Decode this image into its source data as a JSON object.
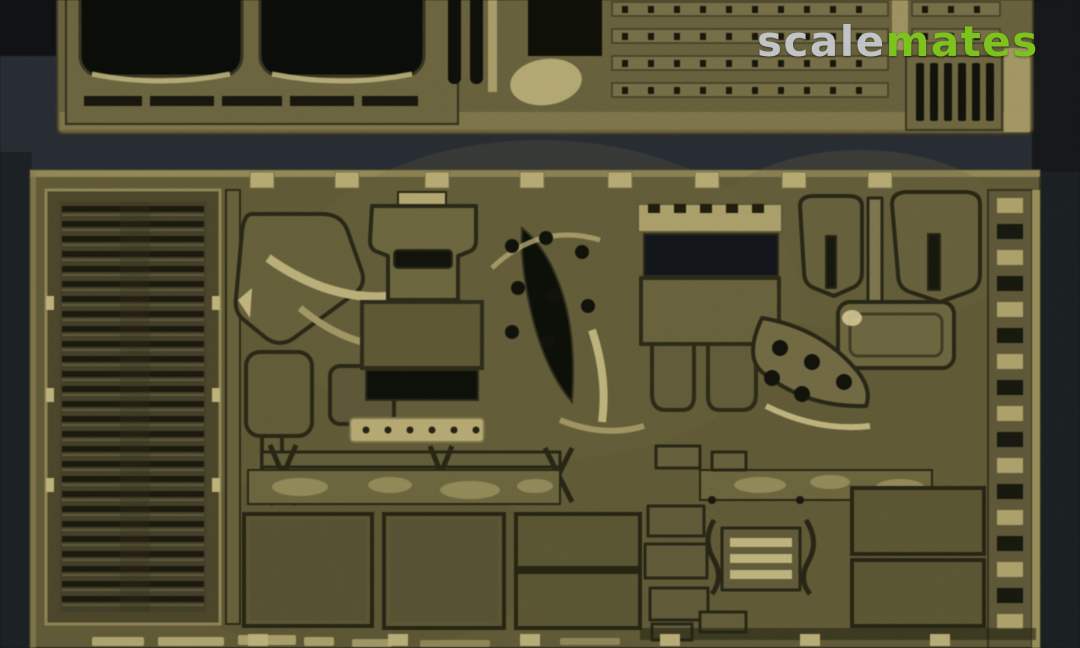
{
  "image_type": "photograph",
  "subject": "Two olive-brass photo-etched detail frets for a scale model kit photographed on a dark blue-grey surface",
  "watermark": {
    "text": "scalemates",
    "part1": "scale",
    "part2": "mates",
    "part1_color": "#c9ccd1",
    "part2_color": "#7dc31e"
  },
  "frets": {
    "top": {
      "name": "top-etch-fret",
      "description": "Upper fret cropped by the image edge: two large rounded fender cut-outs on the left, slotted strips in the middle, four rows of perforated tread strips, and a vertical-slat grille at the right end",
      "base_color": "#756e45"
    },
    "bottom": {
      "name": "bottom-etch-fret",
      "description": "Large lower fret: tall louvered engine grille on the left, curved fender parts, seat back with slot, hinged stowage-bin face with legs, horseshoe brackets, perforated curved bracket, flat hull panels along the bottom, ladder-like runner on the right edge, etched lettering cropped at the bottom",
      "base_color": "#6d663e"
    }
  },
  "palette": {
    "background_top": "#131517",
    "background_band": "#2e333b",
    "background_lower": "#232a2d",
    "brass_base": "#6f6841",
    "brass_light": "#c9bc80",
    "brass_highlight": "#e8dca4",
    "etch_shadow": "#2f2d1a",
    "cutout_dark": "#12140c"
  }
}
